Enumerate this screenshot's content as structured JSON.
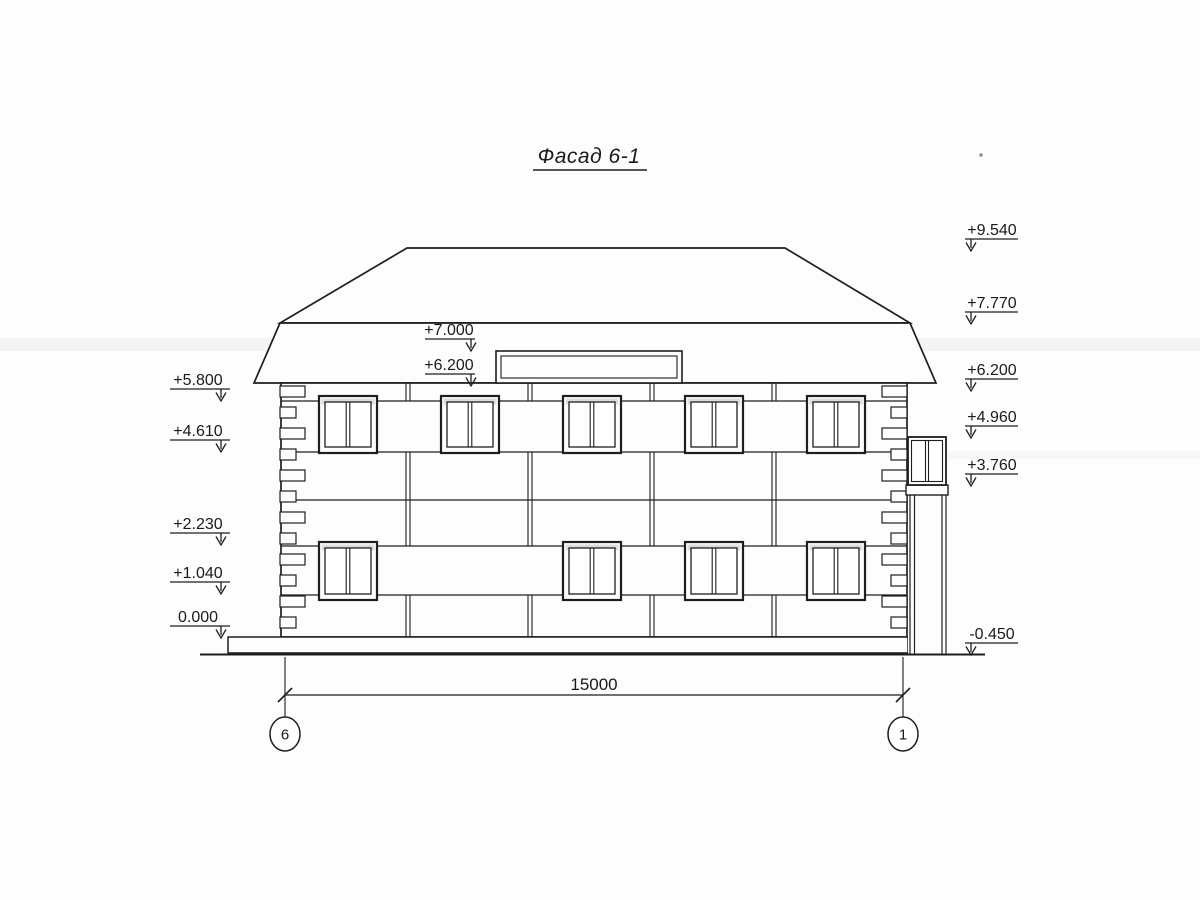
{
  "title": "Фасад 6-1",
  "markers": {
    "left": [
      {
        "label": "+5.800"
      },
      {
        "label": "+4.610"
      },
      {
        "label": "+2.230"
      },
      {
        "label": "+1.040"
      },
      {
        "label": "0.000"
      }
    ],
    "right": [
      {
        "label": "+9.540"
      },
      {
        "label": "+7.770"
      },
      {
        "label": "+6.200"
      },
      {
        "label": "+4.960"
      },
      {
        "label": "+3.760"
      },
      {
        "label": "-0.450"
      }
    ],
    "middle": [
      {
        "label": "+7.000"
      },
      {
        "label": "+6.200"
      }
    ]
  },
  "dimension": {
    "label": "15000"
  },
  "axes": [
    {
      "label": "6"
    },
    {
      "label": "1"
    }
  ],
  "colors": {
    "line": "#1e1e1e",
    "paper": "#fdfdfd"
  }
}
